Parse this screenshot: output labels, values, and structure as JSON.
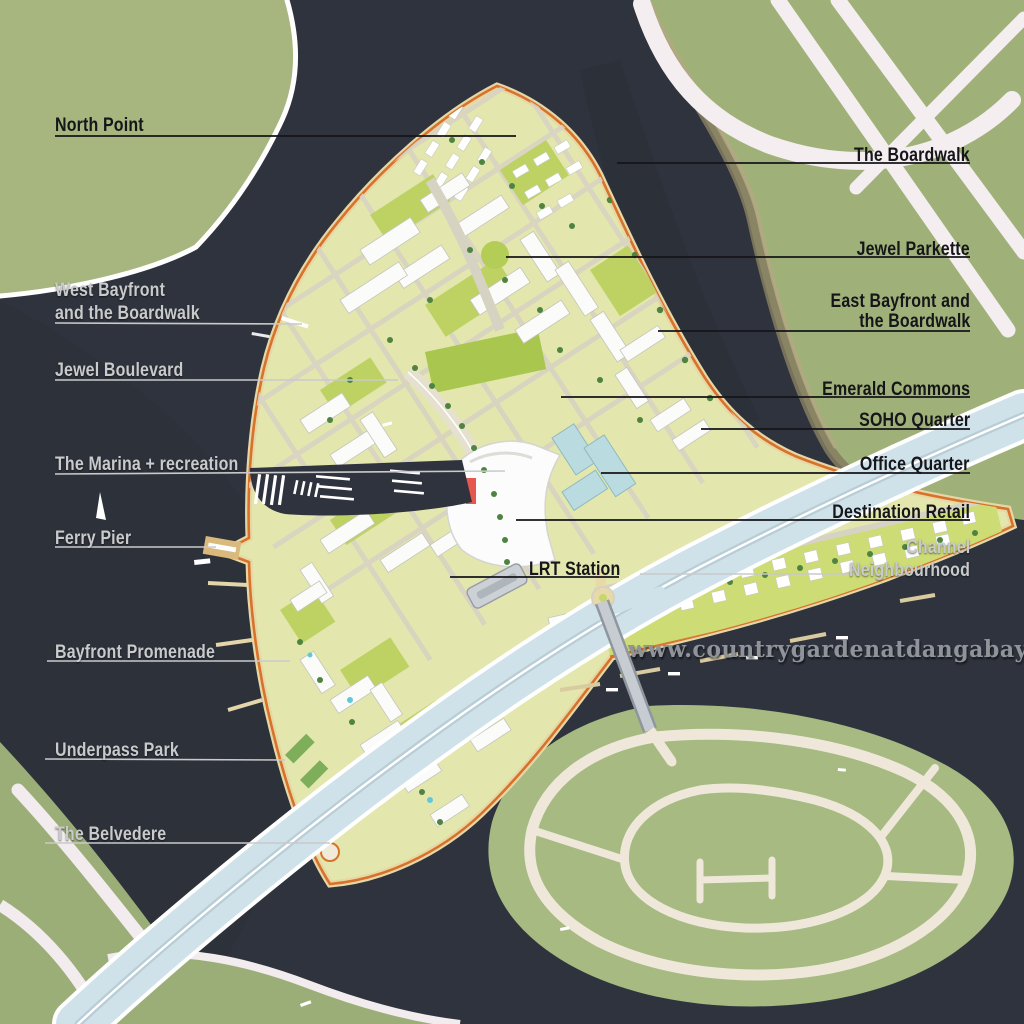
{
  "map": {
    "title": "Waterfront master plan map",
    "watermark": "www.countrygardenatdangabay.com.my",
    "labels": {
      "north_point": "North Point",
      "boardwalk": "The Boardwalk",
      "jewel_parkette": "Jewel Parkette",
      "west_bayfront_line1": "West Bayfront",
      "west_bayfront_line2": "and the Boardwalk",
      "east_bayfront_line1": "East Bayfront and",
      "east_bayfront_line2": "the Boardwalk",
      "jewel_boulevard": "Jewel Boulevard",
      "emerald_commons": "Emerald Commons",
      "soho_quarter": "SOHO Quarter",
      "marina": "The Marina + recreation",
      "office_quarter": "Office Quarter",
      "destination_retail": "Destination Retail",
      "ferry_pier": "Ferry Pier",
      "lrt_station": "LRT Station",
      "channel_line1": "Channel",
      "channel_line2": "Neighbourhood",
      "bayfront_promenade": "Bayfront Promenade",
      "underpass_park": "Underpass Park",
      "belvedere": "The Belvedere"
    },
    "colors": {
      "water": "#2f333d",
      "land_green": "#a0b279",
      "site_base": "#e3e7ad",
      "park_green": "#bed264",
      "road_white": "#f5eef0",
      "highway_deck": "#cfe2e9",
      "shoreline_orange": "#d8712c",
      "label_dark": "#15151a",
      "label_light": "#c9cacb",
      "watermark_gray": "#8f939a"
    }
  }
}
